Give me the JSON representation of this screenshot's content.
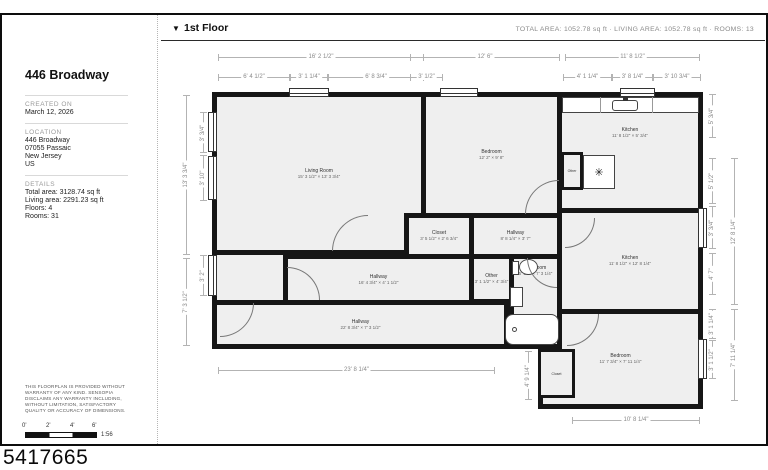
{
  "plan_id": "5417665",
  "sidebar": {
    "title": "446 Broadway",
    "created": {
      "label": "CREATED ON",
      "value": "March 12, 2026"
    },
    "location": {
      "label": "LOCATION",
      "lines": [
        "446 Broadway",
        "07055 Passaic",
        "New Jersey",
        "US"
      ]
    },
    "details": {
      "label": "DETAILS",
      "lines": [
        "Total area: 3128.74 sq ft",
        "Living area: 2291.23 sq ft",
        "Floors: 4",
        "Rooms: 31"
      ]
    },
    "disclaimer": "THIS FLOORPLAN IS PROVIDED WITHOUT WARRANTY OF ANY KIND. SENSOPIA DISCLAIMS ANY WARRANTY INCLUDING, WITHOUT LIMITATION, SATISFACTORY QUALITY OR ACCURACY OF DIMENSIONS.",
    "scale": {
      "ticks": [
        "0'",
        "2'",
        "4'",
        "6'"
      ],
      "ratio": "1:56"
    }
  },
  "header": {
    "dropdown_icon": "▼",
    "floor_label": "1st Floor",
    "summary": "TOTAL AREA: 1052.78 sq ft · LIVING AREA: 1052.78 sq ft · ROOMS: 13"
  },
  "floorplan": {
    "rooms": {
      "living": {
        "name": "Living Room",
        "dims": "15' 3 1/2\" × 13' 3 3/4\""
      },
      "bedroom_top": {
        "name": "Bedroom",
        "dims": "12' 2\" × 9' 8\""
      },
      "kitchen_top": {
        "name": "Kitchen",
        "dims": "11' 8 1/2\" × 5' 3/4\""
      },
      "kitchen_main": {
        "name": "Kitchen",
        "dims": "11' 8 1/2\" × 12' 8 1/4\""
      },
      "closet_mid": {
        "name": "Closet",
        "dims": "3' 5 1/2\" × 2' 6 3/4\""
      },
      "hallway_mid": {
        "name": "Hallway",
        "dims": "8' 8 1/4\" × 3' 7\""
      },
      "other_mid": {
        "name": "Other",
        "dims": "3' 1 1/2\" × 4' 3/4\""
      },
      "bathroom": {
        "name": "Bathroom",
        "dims": "5' 1/2\" × 7' 3 1/4\""
      },
      "hallway_upper": {
        "name": "Hallway",
        "dims": "16' 4 3/4\" × 4' 1 1/2\""
      },
      "hallway_lower": {
        "name": "Hallway",
        "dims": "22' 8 3/4\" × 7' 3 1/2\""
      },
      "bedroom_bottom": {
        "name": "Bedroom",
        "dims": "11' 7 3/4\" × 7' 11 1/4\""
      },
      "closet_bottom": {
        "name": "Closet"
      },
      "other_top": {
        "name": "Other"
      }
    },
    "dims": {
      "t1a": "16' 2 1/2\"",
      "t1b": "12' 6\"",
      "t1c": "11' 8 1/2\"",
      "t2a": "6' 4 1/2\"",
      "t2b": "3' 1 1/4\"",
      "t2c": "6' 8 3/4\"",
      "t2d": "3' 1/2\"",
      "t2e": "4' 1 1/4\"",
      "t2f": "3' 8 1/4\"",
      "t2g": "3' 10 3/4\"",
      "l1a": "13' 3 3/4\"",
      "l1b": "7' 3 1/2\"",
      "l2a": "3' 3/4\"",
      "l2b": "3' 10\"",
      "l2c": "3' 2\"",
      "r1a": "12' 8 1/4\"",
      "r1b": "7' 11 1/4\"",
      "r2a": "5' 3/4\"",
      "r2b": "5' 1/2\"",
      "r2c": "3' 3/4\"",
      "r2d": "4' 7\"",
      "r2e": "3' 1 1/4\"",
      "r2f": "3' 1 1/2\"",
      "b1": "23' 8 1/4\"",
      "b2": "4' 9 1/4\"",
      "b3": "10' 8 1/4\""
    },
    "icons": {
      "fan": "✳"
    }
  }
}
